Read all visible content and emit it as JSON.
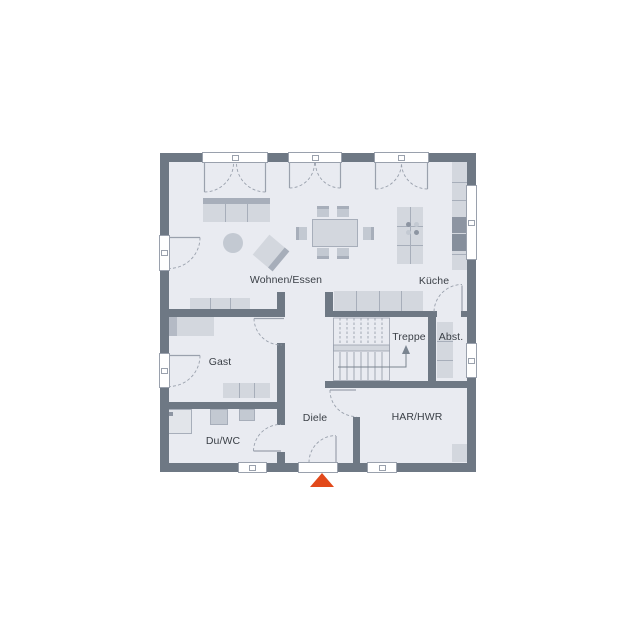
{
  "plan": {
    "rooms": [
      {
        "id": "living",
        "label": "Wohnen/Essen"
      },
      {
        "id": "kitchen",
        "label": "Küche"
      },
      {
        "id": "stairs",
        "label": "Treppe"
      },
      {
        "id": "storage",
        "label": "Abst."
      },
      {
        "id": "guest",
        "label": "Gast"
      },
      {
        "id": "hall",
        "label": "Diele"
      },
      {
        "id": "wc",
        "label": "Du/WC"
      },
      {
        "id": "utility",
        "label": "HAR/HWR"
      }
    ],
    "entrance_marker": "triangle-up",
    "colors": {
      "wall": "#6e7884",
      "floor": "#e9ebf1",
      "furn": "#d3d7de",
      "furn_mid": "#c3c9d2",
      "furn_dark": "#a7aeba",
      "appliance": "#8d95a2",
      "line": "#9aa1ad",
      "text": "#3a3f46",
      "accent": "#e2491a"
    }
  }
}
